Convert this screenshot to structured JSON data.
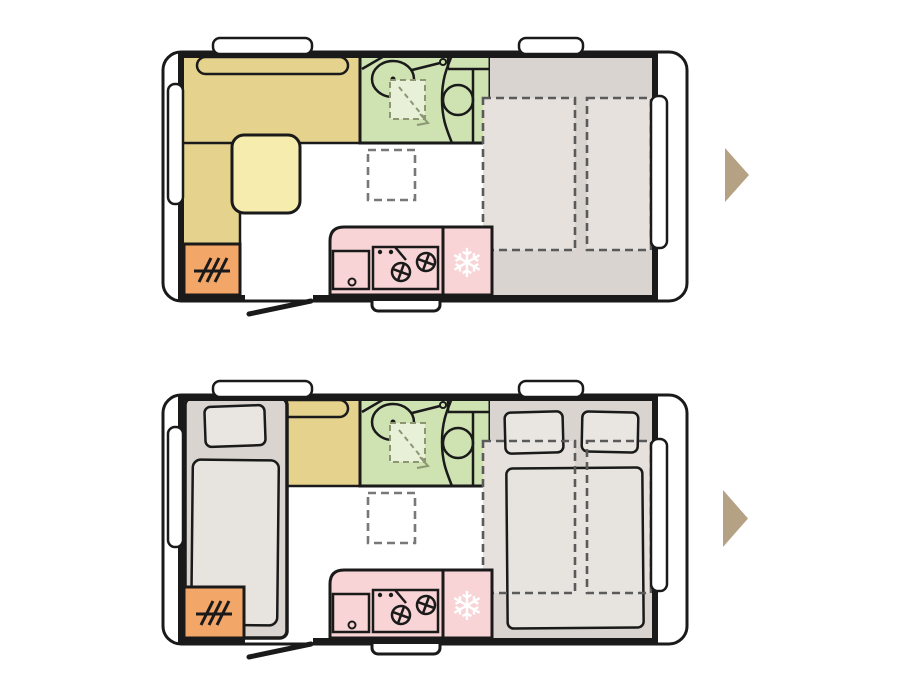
{
  "canvas": {
    "width": 906,
    "height": 680,
    "background": "#ffffff"
  },
  "colors": {
    "outline": "#1a1a1a",
    "bench": "#e5d38d",
    "table": "#f6ecae",
    "heater": "#f2a668",
    "bath": "#cfe2b2",
    "shower": "#e8f0d8",
    "showerdash": "#8c9673",
    "kitchen": "#f9d4d6",
    "taupe": "#d9d4cf",
    "bedlight": "#e6e1dd",
    "pillow": "#e9e5e1",
    "duvet": "#e7e3de",
    "dash": "#5a5a5a",
    "dashgrey": "#787878",
    "arrow": "#b5a285",
    "snow": "#ffffff"
  },
  "icons": {
    "snowflake": "❄",
    "next_arrow": "▶"
  }
}
